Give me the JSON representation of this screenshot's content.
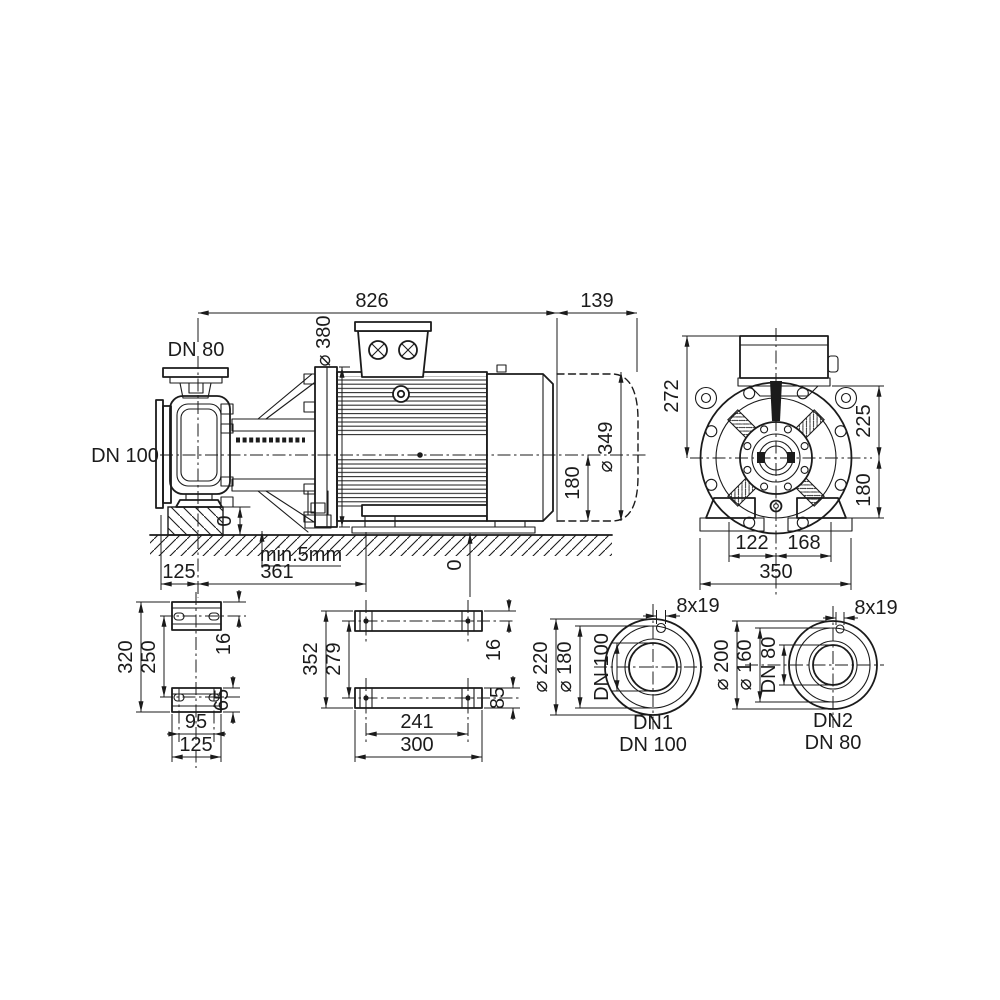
{
  "drawing_title": "pump-dimension-drawing",
  "side": {
    "len_total": "826",
    "len_fan": "139",
    "port_top": "DN 80",
    "dia_flange": "⌀ 380",
    "port_suction": "DN 100",
    "dia_motor": "⌀ 349",
    "h_axis": "180",
    "zero_left": "0",
    "note_gap": "min.5mm",
    "x_suction": "125",
    "x_foot": "361",
    "zero_right": "0"
  },
  "end": {
    "h_top": "272",
    "h_box": "225",
    "h_base": "180",
    "w_left": "122",
    "w_right": "168",
    "w_total": "350"
  },
  "pump_feet": {
    "l_total": "320",
    "l_holes": "250",
    "edge": "16",
    "pad": "65",
    "w_holes": "95",
    "w_total": "125"
  },
  "motor_feet": {
    "l_total": "352",
    "l_holes": "279",
    "edge": "16",
    "pad": "85",
    "w_holes": "241",
    "w_total": "300"
  },
  "flange1": {
    "holes": "8x19",
    "d_outer": "⌀ 220",
    "d_bolt": "⌀ 180",
    "d_bore": "DN 100",
    "name": "DN1",
    "size": "DN 100"
  },
  "flange2": {
    "holes": "8x19",
    "d_outer": "⌀ 200",
    "d_bolt": "⌀ 160",
    "d_bore": "DN 80",
    "name": "DN2",
    "size": "DN 80"
  }
}
